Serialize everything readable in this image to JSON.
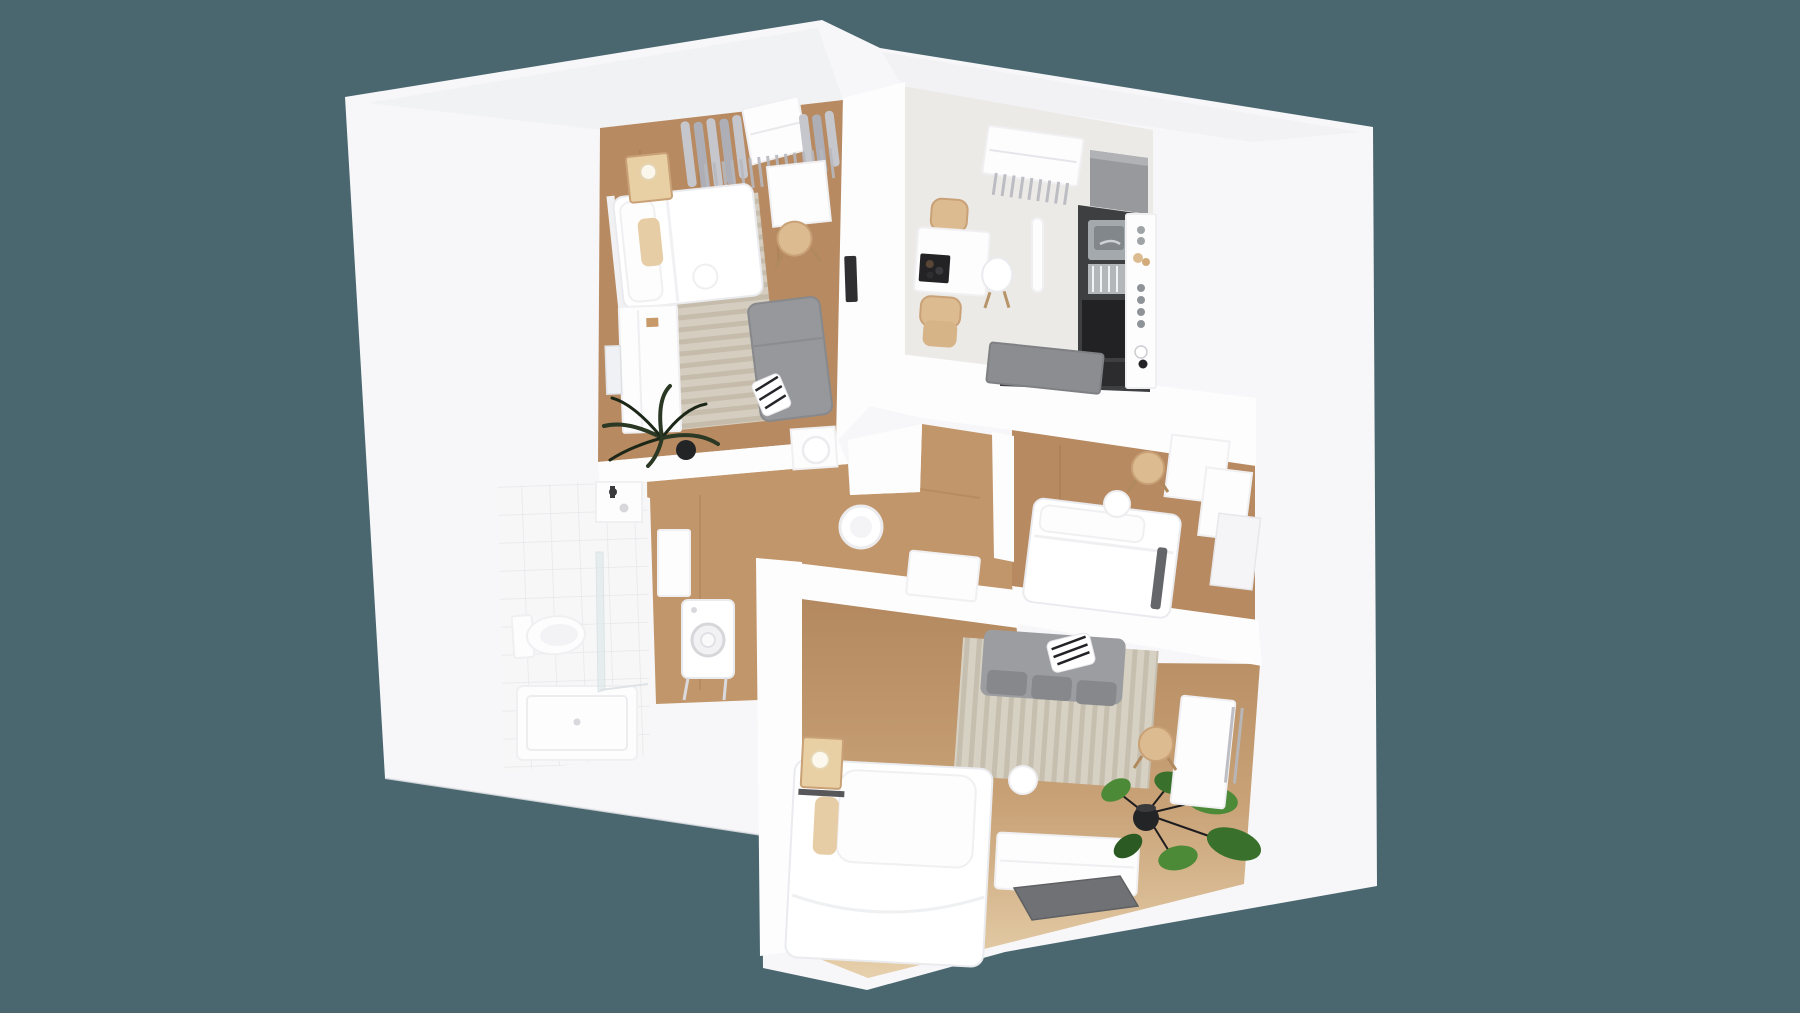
{
  "scene": {
    "kind": "3d-apartment-floor-plan-render",
    "view": "isometric-cutaway-top-down",
    "background_color": "#4a6770"
  },
  "colors": {
    "bg": "#4a6770",
    "wall": "#f7f7f9",
    "wall_inner": "#fdfdfe",
    "wall_edge": "#e3e4e8",
    "roof_shade": "#eff0f3",
    "wood": "#b78a61",
    "hall_wood": "#c2966b",
    "wood_streak": "#9d7349",
    "wood_light": "#e2c9a2",
    "kitchen_floor": "#eceae7",
    "tile": "#f7f7f8",
    "tile_line": "#e7e7ea",
    "rug": "#d7d1c4",
    "rug_stripe": "#c6bfaf",
    "sofa_gray": "#9b9da1",
    "sofa_cushion": "#86888c",
    "chaise_gray": "#96989c",
    "counter_dark": "#3e3f41",
    "counter_black": "#202022",
    "steel": "#a4a9ad",
    "steel_dark": "#82878b",
    "cabinet_gray": "#97999d",
    "island_gray": "#8b8d90",
    "chair_tan": "#ddbb90",
    "chair_tan_dark": "#c9a176",
    "nightstand": "#e9cfa4",
    "furniture_white": "#ffffff",
    "furniture_stroke": "#eaebee",
    "plant_green": "#4c8a38",
    "plant_green_dark": "#38702c",
    "plant_green_deep": "#2c5a23",
    "palm_dark": "#2a3824",
    "palm_deep": "#1c2718",
    "pot_black": "#232426",
    "tv_gray": "#6f7174",
    "radiator": "#b7b8be",
    "curtain": "#c6c7cd",
    "curtain_dark": "#aeafb6",
    "glass_tint": "#dce8ea"
  },
  "rooms": [
    {
      "id": "bedroom-1",
      "label": "bedroom top left",
      "furniture": [
        "double-bed",
        "pillows",
        "bed-lamp",
        "wood-nightstand",
        "striped-rug",
        "desk",
        "wood-chair",
        "gray-daybed",
        "striped-blanket",
        "white-dresser",
        "wall-mirror",
        "palm-plant",
        "curtains",
        "skylight-window",
        "radiator",
        "wall-panel",
        "round-stool",
        "open-door"
      ]
    },
    {
      "id": "kitchen",
      "label": "kitchen top right",
      "furniture": [
        "dining-table",
        "serving-board",
        "wood-chair",
        "wood-chair",
        "shell-chair",
        "kitchen-counter",
        "steel-sink",
        "dish-rack",
        "oven",
        "corner-cabinet",
        "spice-shelf",
        "kitchen-island",
        "skylight-window",
        "radiator",
        "wall-light"
      ]
    },
    {
      "id": "bedroom-2",
      "label": "bedroom middle right",
      "furniture": [
        "bed",
        "pillow",
        "dark-throw",
        "round-side-table",
        "desk",
        "wood-chair",
        "wardrobe",
        "side-panel"
      ]
    },
    {
      "id": "living-bedroom",
      "label": "living room bottom",
      "furniture": [
        "double-bed",
        "pillows",
        "tan-pillow",
        "wood-nightstand",
        "bed-lamp",
        "gray-sofa",
        "striped-blanket",
        "striped-rug",
        "round-side-table",
        "white-sideboard",
        "tv-panel",
        "potted-plant",
        "desk",
        "wood-chair",
        "radiator"
      ]
    },
    {
      "id": "bathroom",
      "label": "bathroom left",
      "furniture": [
        "toilet",
        "wash-basin",
        "black-faucet",
        "shower-tray",
        "glass-screen",
        "tiled-floor"
      ]
    },
    {
      "id": "hallway",
      "label": "hallway center",
      "furniture": [
        "ceiling-lamp",
        "washing-machine",
        "wall-cabinet",
        "low-sideboard",
        "wood-floor"
      ]
    }
  ]
}
